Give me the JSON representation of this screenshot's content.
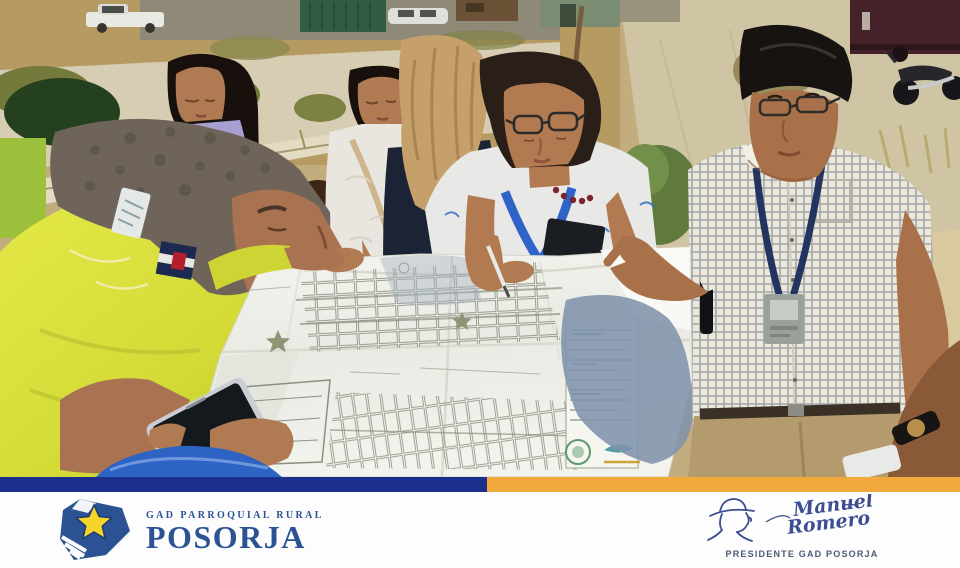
{
  "footer": {
    "brand": {
      "tagline": "GAD PARROQUIAL RURAL",
      "name": "POSORJA"
    },
    "signature": {
      "first_name": "Manuel",
      "last_name": "Romero",
      "title": "PRESIDENTE GAD POSORJA"
    },
    "colors": {
      "bar_navy": "#1b2e8c",
      "bar_orange": "#f2a93b",
      "brand_navy": "#2b5394",
      "star_yellow": "#f6d42a",
      "signature_ink": "#3c4d91"
    }
  }
}
